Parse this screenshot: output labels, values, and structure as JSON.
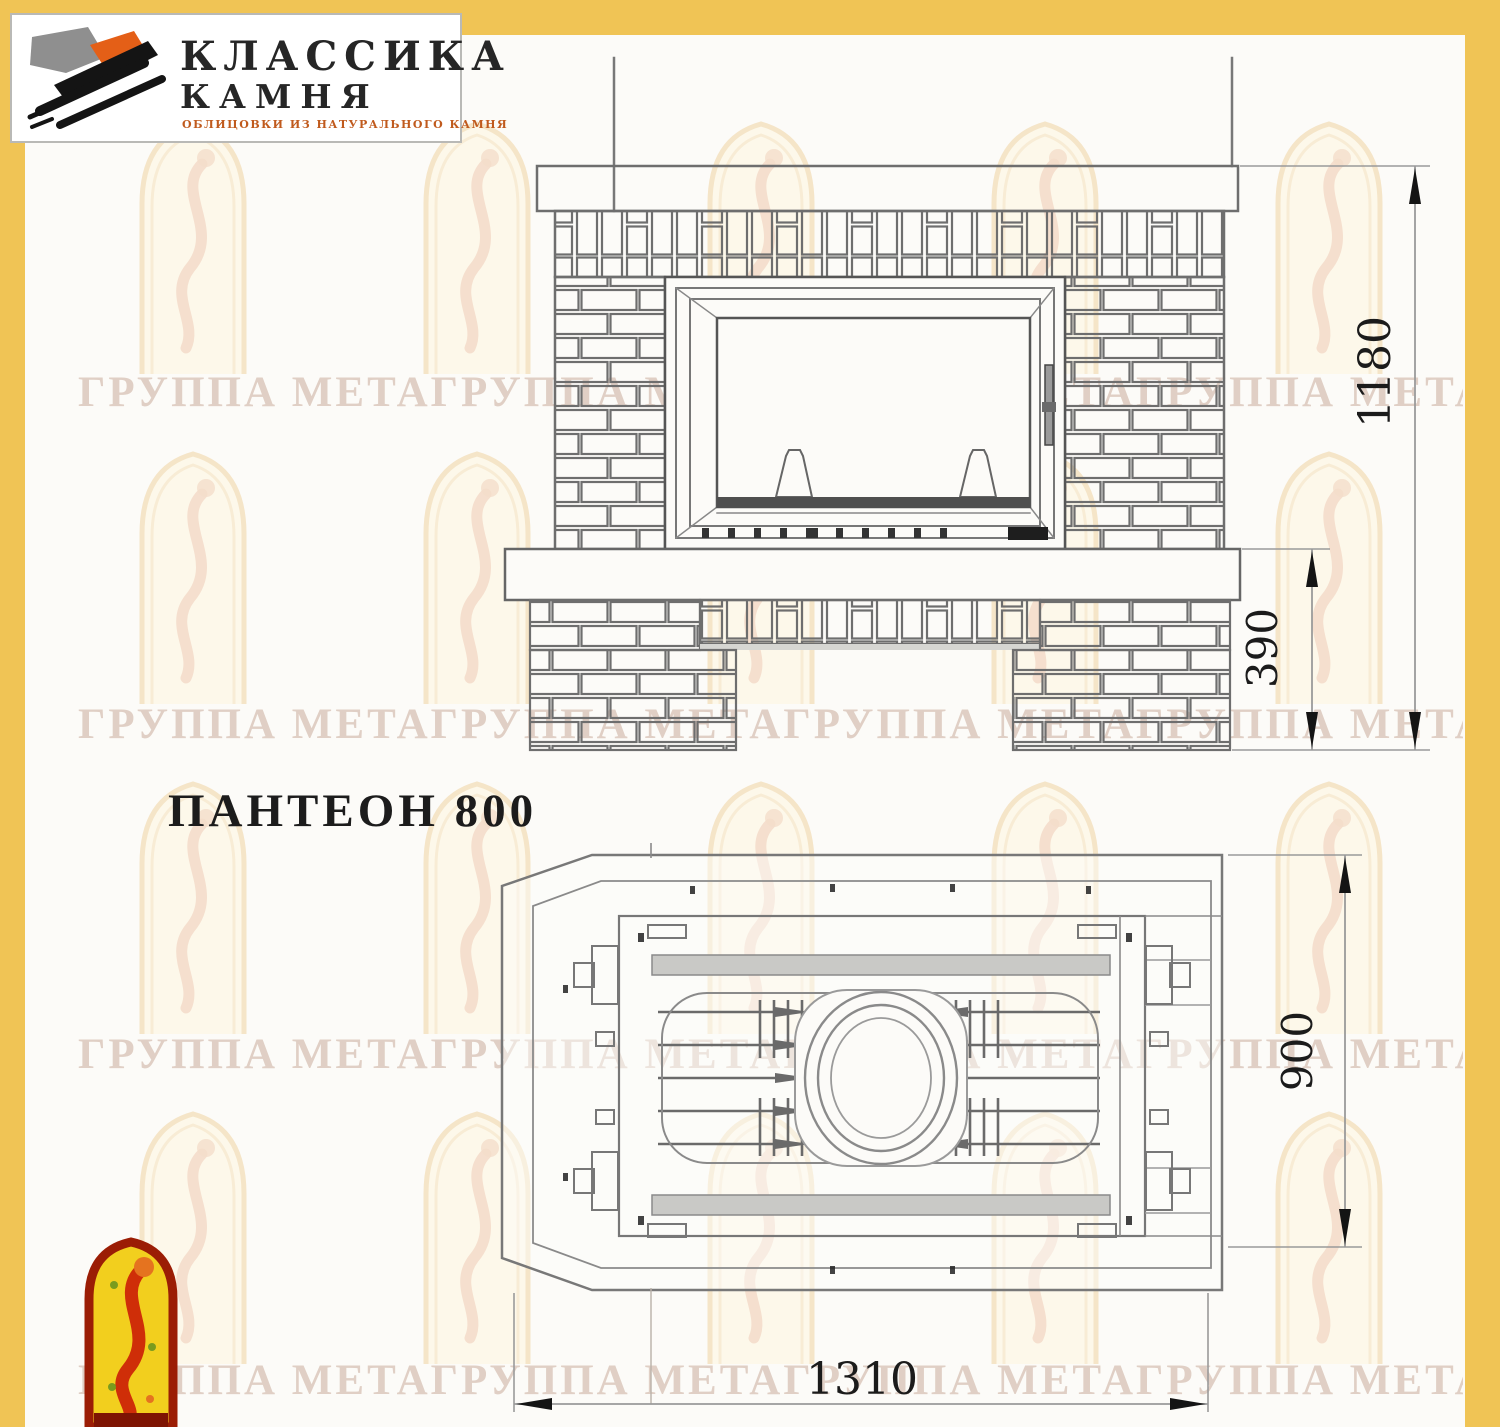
{
  "title": "ПАНТЕОН 800",
  "logo": {
    "icon": "stone-texture-icon",
    "title_line1": "КЛАССИКА",
    "title_line2": "КАМНЯ",
    "subtitle": "ОБЛИЦОВКИ ИЗ НАТУРАЛЬНОГО КАМНЯ"
  },
  "watermark": {
    "text": "ГРУППА МЕТАГРУППА МЕТАГРУППА МЕТАГРУППА МЕТА",
    "arch_icon": "arched-window-figure-icon"
  },
  "emblem": {
    "icon": "arched-window-figure-icon"
  },
  "drawing": {
    "front_view": {
      "name": "front elevation of fireplace",
      "height_mm": "1180",
      "base_height_mm": "390"
    },
    "plan_view": {
      "name": "top plan of fireplace",
      "depth_mm": "900",
      "width_mm": "1310"
    }
  },
  "colors": {
    "accent_yellow": "#f0c455",
    "line_grey": "#6e6e6e",
    "dim_dark": "#1b1b1b",
    "watermark_pink": "#d9c5b8",
    "arch_cream": "#fdf6e2",
    "logo_orange": "#e45f17",
    "emblem_yellow": "#f2cf1e",
    "emblem_red": "#9b1d05"
  }
}
